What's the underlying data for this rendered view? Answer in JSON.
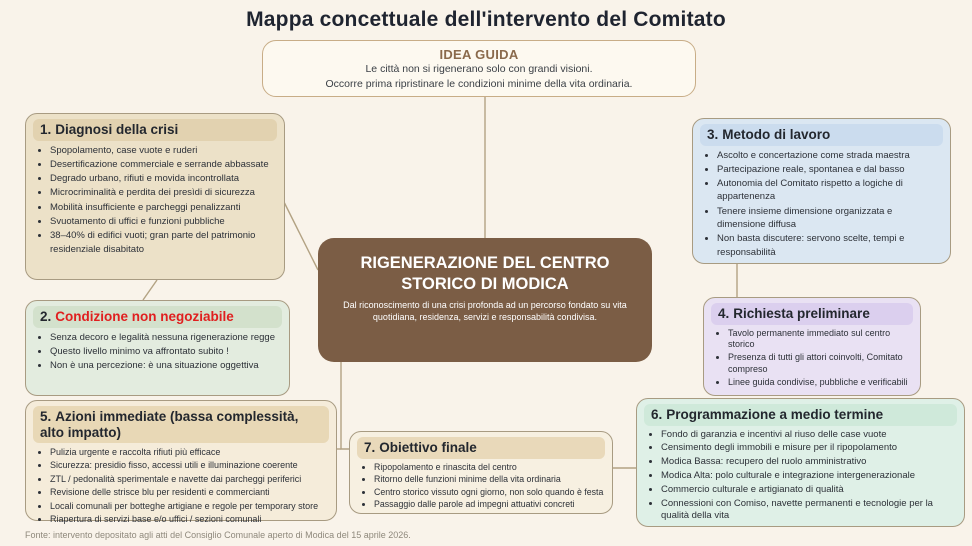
{
  "title": "Mappa concettuale dell'intervento del Comitato",
  "idea_guida": {
    "heading": "IDEA GUIDA",
    "line1": "Le città non si rigenerano solo con grandi visioni.",
    "line2": "Occorre prima ripristinare le condizioni minime della vita ordinaria."
  },
  "central": {
    "title": "RIGENERAZIONE DEL CENTRO STORICO DI MODICA",
    "subtitle": "Dal riconoscimento di una crisi profonda ad un percorso fondato su vita quotidiana, residenza, servizi e responsabilità condivisa."
  },
  "boxes": {
    "box1": {
      "number": "1.",
      "title": "Diagnosi della crisi",
      "bullets": [
        "Spopolamento, case vuote e ruderi",
        "Desertificazione commerciale e serrande abbassate",
        "Degrado urbano, rifiuti e movida incontrollata",
        "Microcriminalità e perdita dei presìdi di sicurezza",
        "Mobilità insufficiente e parcheggi penalizzanti",
        "Svuotamento di uffici e funzioni pubbliche",
        "38–40% di edifici vuoti; gran parte del patrimonio residenziale disabitato"
      ]
    },
    "box2": {
      "number": "2.",
      "title": "Condizione non negoziabile",
      "bullets": [
        "Senza decoro e legalità nessuna rigenerazione regge",
        "Questo livello minimo va affrontato subito !",
        "Non è una percezione: è una situazione oggettiva"
      ]
    },
    "box3": {
      "number": "3.",
      "title": "Metodo di lavoro",
      "bullets": [
        "Ascolto e concertazione come strada maestra",
        "Partecipazione reale, spontanea e dal basso",
        "Autonomia del Comitato rispetto a logiche di appartenenza",
        "Tenere insieme dimensione organizzata e dimensione diffusa",
        "Non basta discutere: servono scelte, tempi e responsabilità"
      ]
    },
    "box4": {
      "number": "4.",
      "title": "Richiesta preliminare",
      "bullets": [
        "Tavolo permanente immediato sul centro storico",
        "Presenza di tutti gli attori coinvolti, Comitato compreso",
        "Linee guida condivise, pubbliche e verificabili"
      ]
    },
    "box5": {
      "number": "5.",
      "title": "Azioni immediate (bassa complessità, alto impatto)",
      "bullets": [
        "Pulizia urgente e raccolta rifiuti più efficace",
        "Sicurezza: presidio fisso, accessi utili e illuminazione coerente",
        "ZTL / pedonalità sperimentale e navette dai parcheggi periferici",
        "Revisione delle strisce blu per residenti e commercianti",
        "Locali comunali per botteghe artigiane e regole per temporary store",
        "Riapertura di servizi base e/o uffici / sezioni comunali"
      ]
    },
    "box6": {
      "number": "6.",
      "title": "Programmazione a medio termine",
      "bullets": [
        "Fondo di garanzia e incentivi al riuso delle case vuote",
        "Censimento degli immobili e misure per il ripopolamento",
        "Modica Bassa: recupero del ruolo amministrativo",
        "Modica Alta: polo culturale e integrazione intergenerazionale",
        "Commercio culturale e artigianato di qualità",
        "Connessioni con Comiso, navette permanenti e tecnologie per la qualità della vita"
      ]
    },
    "box7": {
      "number": "7.",
      "title": "Obiettivo finale",
      "bullets": [
        "Ripopolamento e rinascita del centro",
        "Ritorno delle funzioni minime della vita ordinaria",
        "Centro storico vissuto ogni giorno, non solo quando è festa",
        "Passaggio dalle parole ad impegni attuativi concreti"
      ]
    }
  },
  "footer": "Fonte: intervento depositato agli atti del Consiglio Comunale aperto di Modica del 15 aprile 2026.",
  "colors": {
    "background": "#f9f3ea",
    "central_brown": "#7b5d45",
    "box2_title_red": "#e01f1f",
    "idea_heading_brown": "#8a6a4c",
    "connector": "#b3a283"
  }
}
